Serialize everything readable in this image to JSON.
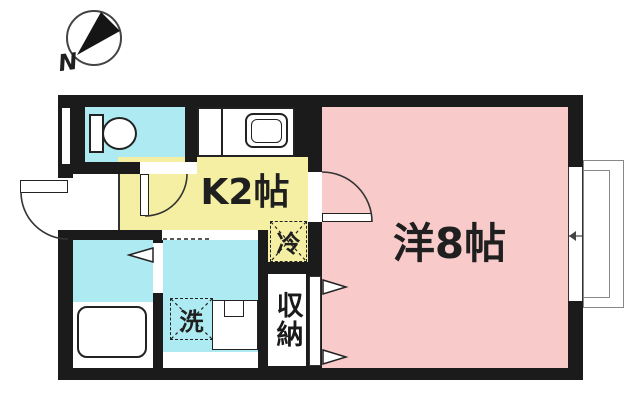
{
  "compass": {
    "north_label": "N"
  },
  "rooms": {
    "kitchen": {
      "label": "K2帖"
    },
    "main_room": {
      "label": "洋8帖"
    }
  },
  "fixtures": {
    "refrigerator": {
      "label": "冷"
    },
    "washing_machine": {
      "label": "洗"
    },
    "closet": {
      "label": "収納"
    }
  },
  "colors": {
    "wall": "#1b1b1b",
    "kitchen_floor": "#f4efa2",
    "main_room_floor": "#f8cbca",
    "wet_area_floor": "#aeeaf1",
    "compass_needle": "#151515"
  }
}
